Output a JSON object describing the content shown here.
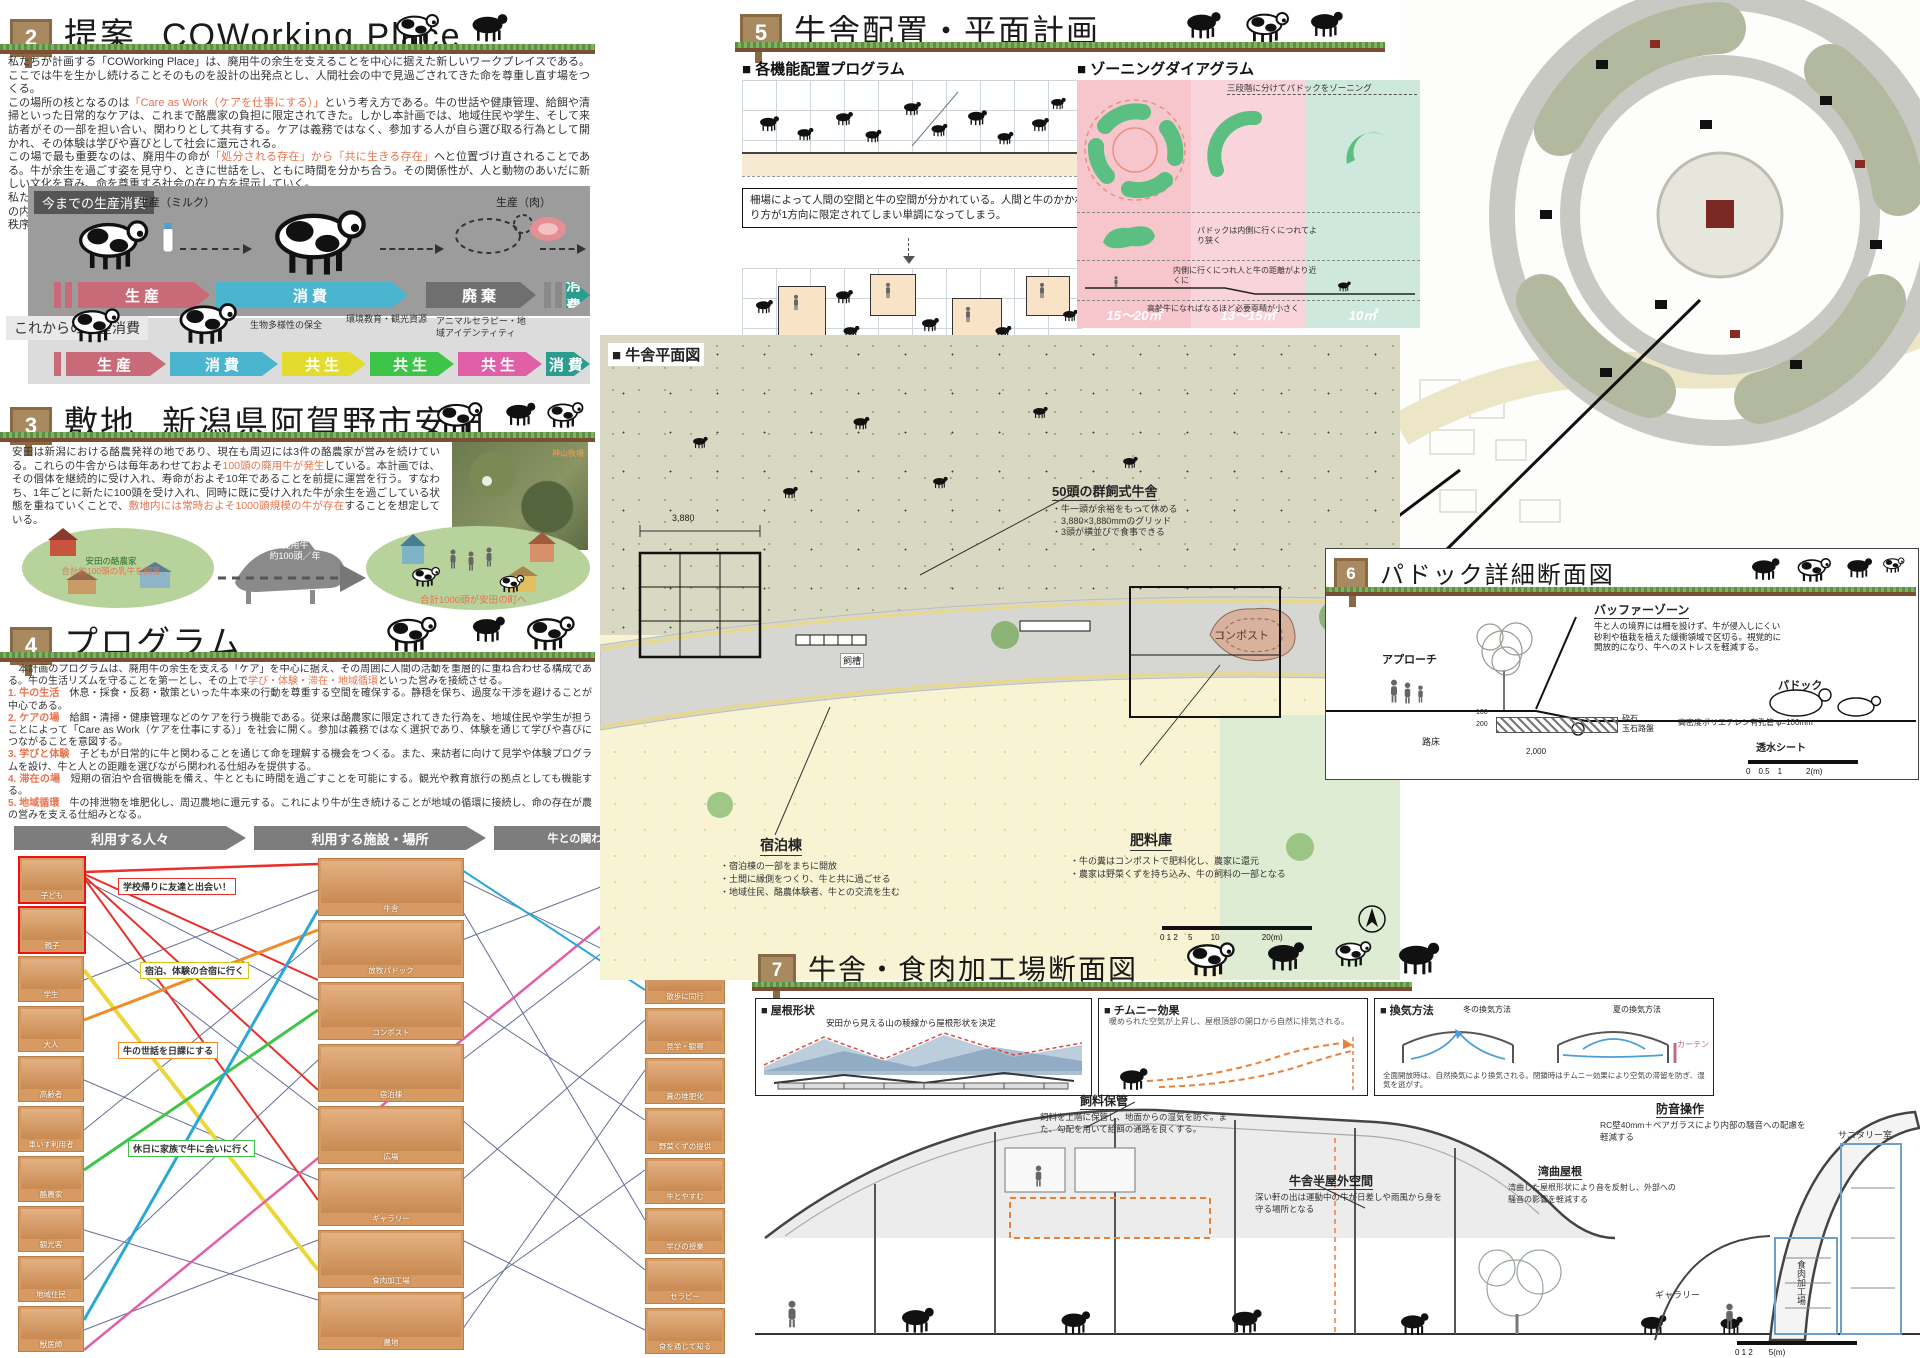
{
  "colors": {
    "accent_orange": "#e8734d",
    "flow_red": "#c96a78",
    "flow_blue": "#4ab5ce",
    "flow_gray": "#6f6f6f",
    "flow_teal": "#2a9d8f",
    "flow_yellow": "#e8e030",
    "flow_green": "#3fc44a",
    "flow_pink": "#e060a8",
    "zoning_pink": "#f7c6cd",
    "zoning_mint": "#cfe8dd",
    "tile_tan": "#d79a62"
  },
  "s2": {
    "num": "2",
    "title": "提案",
    "subtitle": "COWorking Place",
    "p1": "私たちが計画する「COWorking Place」は、廃用牛の余生を支えることを中心に据えた新しいワークプレイスである。ここでは牛を生かし続けることそのものを設計の出発点とし、人間社会の中で見過ごされてきた命を尊重し直す場をつくる。",
    "p2a": "この場所の核となるのは",
    "p2hl": "「Care as Work（ケアを仕事にする）」",
    "p2b": "という考え方である。牛の世話や健康管理、給餌や清掃といった日常的なケアは、これまで酪農家の負担に限定されてきた。しかし本計画では、地域住民や学生、そして来訪者がその一部を担い合い、関わりとして共有する。ケアは義務ではなく、参加する人が自ら選び取る行為として開かれ、その体験は学びや喜びとして社会に還元される。",
    "p3a": "この場で最も重要なのは、廃用牛の命が",
    "p3hl": "「処分される存在」から「共に生きる存在」",
    "p3b": "へと位置づけ直されることである。牛が余生を過ごす姿を見守り、ときに世話をし、ともに時間を分かち合う。その関係性が、人と動物のあいだに新しい文化を育み、命を尊重する社会の在り方を提示していく。",
    "p4": "私たちの提案は、牛を生かすという具体的な行為を通じて、人と牛の共生を日常に取り込み、生物多様性を人間社会の内部へと拡張する試みである。廃用牛を尊重し、その存在を地域社会に取り戻すことこそが、未来に向けた新しい秩序の提案だと考える。"
  },
  "flow": {
    "old_title": "今までの生産消費",
    "new_title": "これからの生産消費",
    "milk": "生産（ミルク）",
    "meat": "生産（肉）",
    "old_steps": [
      "生産",
      "消費",
      "廃棄",
      "消費"
    ],
    "new_steps": [
      "生産",
      "消費",
      "共生",
      "共生",
      "共生",
      "消費"
    ],
    "notes": [
      "生物多様性の保全",
      "環境教育・観光資源",
      "アニマルセラピー・地域アイデンティティ"
    ]
  },
  "s3": {
    "num": "3",
    "title": "敷地",
    "subtitle": "新潟県阿賀野市安田",
    "p_a": "安田は新潟における酪農発祥の地であり、現在も周辺には3件の酪農家が営みを続けている。これらの牛舎からは毎年あわせておよそ",
    "p_hl1": "100頭の廃用牛が発生",
    "p_b": "している。本計画では、その個体を継続的に受け入れ、寿命がおよそ10年であることを前提に運営を行う。すなわち、1年ごとに新たに100頭を受け入れ、同時に既に受け入れた牛が余生を過ごしている状態を重ねていくことで、",
    "p_hl2": "敷地内には常時およそ1000頭規模の牛が存在",
    "p_c": "することを想定している。",
    "d_left1": "安田の酪農家",
    "d_left2": "合計約100頭の乳牛を飼育",
    "d_cow1": "廃用牛",
    "d_cow2": "約100頭／年",
    "d_right": "合計1000頭が安田の町へ",
    "photo_label": "神山牧場"
  },
  "s4": {
    "num": "4",
    "title": "プログラム",
    "intro_a": "　本計画のプログラムは、廃用牛の余生を支える「ケア」を中心に据え、その周囲に人間の活動を重層的に重ね合わせる構成である。牛の生活リズムを守ることを第一とし、その上で",
    "intro_hl": "学び・体験・滞在・地域循環",
    "intro_b": "といった営みを接続させる。",
    "items": [
      {
        "h": "1. 牛の生活",
        "d": "　休息・採食・反芻・散策といった牛本来の行動を尊重する空間を確保する。静穏を保ち、過度な干渉を避けることが中心である。"
      },
      {
        "h": "2. ケアの場",
        "d": "　給餌・清掃・健康管理などのケアを行う機能である。従来は酪農家に限定されてきた行為を、地域住民や学生が担うことによって「Care as Work（ケアを仕事にする）」を社会に開く。参加は義務ではなく選択であり、体験を通じて学びや喜びにつながることを意図する。"
      },
      {
        "h": "3. 学びと体験",
        "d": "　子どもが日常的に牛と関わることを通じて命を理解する機会をつくる。また、来訪者に向けて見学や体験プログラムを設け、牛と人との距離を選びながら関われる仕組みを提供する。"
      },
      {
        "h": "4. 滞在の場",
        "d": "　短期の宿泊や合宿機能を備え、牛とともに時間を過ごすことを可能にする。観光や教育旅行の拠点としても機能する。"
      },
      {
        "h": "5. 地域循環",
        "d": "　牛の排泄物を堆肥化し、周辺農地に還元する。これにより牛が生き続けることが地域の循環に接続し、命の存在が農の営みを支える仕組みとなる。"
      }
    ],
    "outro_a": "以上のプログラムは、牛を単なる生産資源ではなく",
    "outro_hl": "「共に生きる存在」",
    "outro_b": "として位置づけ直し、人の営みと重ね合わせることで、新しい多様性の枠組みを提示するものである。"
  },
  "matrix": {
    "headers": [
      "利用する人々",
      "利用する施設・場所",
      "牛との関わり方・つながり方"
    ],
    "people": [
      "子ども",
      "親子",
      "学生",
      "大人",
      "高齢者",
      "車いす利用者",
      "酪農家",
      "観光客",
      "地域住民",
      "獣医師"
    ],
    "places": [
      "牛舎",
      "放牧パドック",
      "コンポスト",
      "宿泊棟",
      "広場",
      "ギャラリー",
      "食肉加工場",
      "農地"
    ],
    "relations": [
      "餌やり",
      "ブラッシング",
      "散歩に同行",
      "見学・観察",
      "糞の堆肥化",
      "野菜くずの提供",
      "牛とやすむ",
      "学びの授業",
      "セラピー",
      "食を通じて知る"
    ],
    "ribbons": [
      {
        "text": "学校帰りに友達と出会い！"
      },
      {
        "text": "宿泊、体験の合宿に行く"
      },
      {
        "text": "牛の世話を日課にする"
      },
      {
        "text": "休日に家族で牛に会いに行く"
      }
    ]
  },
  "s5": {
    "num": "5",
    "title": "牛舎配置・平面計画",
    "sub1": "各機能配置プログラム",
    "sub2": "ゾーニングダイアグラム",
    "box1": "柵場によって人間の空間と牛の空間が分かれている。人間と牛のかかわり方が1方向に限定されてしまい単調になってしまう。",
    "box2": "人間の活動空間を牛の空間にあふれださせる。人と牛が空間を共有し、様々な触れ合いが生まれる。",
    "zone_caption": "三段階に分けてパドックをゾーニング",
    "zone_notes": [
      "パドックは内側に行くにつれてより狭く",
      "内側に行くにつれ人と牛の距離がより近くに",
      "内側では人と牛が最も近くで過ごす",
      "高齢牛になればなるほど必要面積が小さく"
    ],
    "zone_values": [
      "15〜20㎡",
      "13〜15㎡",
      "10㎡"
    ]
  },
  "plan": {
    "title": "牛舎平面図",
    "barn_title": "50頭の群飼式牛舎",
    "barn_b1": "・牛一頭が余裕をもって休める",
    "barn_b2": "　3,880×3,880mmのグリッド",
    "barn_b3": "・3頭が横並びで食事できる",
    "dim": "3,880",
    "compost": "コンポスト",
    "trough": "飼槽",
    "lodging_title": "宿泊棟",
    "lodging_b1": "・宿泊棟の一部をまちに開放",
    "lodging_b2": "・土間に縁側をつくり、牛と共に過ごせる",
    "lodging_b3": "・地域住民、酪農体験者、牛との交流を生む",
    "fert_title": "肥料庫",
    "fert_b1": "・牛の糞はコンポストで肥料化し、農家に還元",
    "fert_b2": "・農家は野菜くずを持ち込み、牛の飼料の一部となる",
    "scale": "0 1 2　 5　　 10　　　　　 20(m)"
  },
  "s6": {
    "num": "6",
    "title": "パドック詳細断面図",
    "buffer_title": "バッファーゾーン",
    "buffer_text": "牛と人の境界には柵を設けず、牛が侵入しにくい砂利や植栽を植えた緩衝領域で区切る。視覚的に開放的になり、牛へのストレスを軽減する。",
    "approach": "アプローチ",
    "paddock": "パドック",
    "l_gravel": "砕石",
    "l_cobble": "玉石路盤",
    "l_pipe": "高密度ポリエチレン有孔管 φ=100mm",
    "l_roadbed": "路床",
    "l_sheet": "透水シート",
    "dim1": "100",
    "dim2": "200",
    "dim3": "2,000",
    "scale": "0　0.5　1　　　2(m)"
  },
  "s7": {
    "num": "7",
    "title": "牛舎・食肉加工場断面図",
    "b1_title": "屋根形状",
    "b1_cap": "安田から見える山の稜線から屋根形状を決定",
    "b2_title": "チムニー効果",
    "b2_cap": "暖められた空気が上昇し、屋根頂部の開口から自然に排気される。",
    "b3_title": "換気方法",
    "b3_w": "冬の換気方法",
    "b3_s": "夏の換気方法",
    "b3_curtain": "カーテン",
    "b3_cap": "全面開放時は、自然換気により換気される。閉鎖時はチムニー効果により空気の滞留を防ぎ、湿気を逃がす。",
    "feed_t": "飼料保管",
    "feed_d": "飼料を上階に保管し、地面からの湿気を防ぐ。また、勾配を用いて給餌の通路を良くする。",
    "semi_t": "牛舎半屋外空間",
    "semi_d": "深い軒の出は運動中の牛が日差しや雨風から身を守る場所となる",
    "sound_t": "防音操作",
    "sound_d": "RC壁40mm＋ペアガラスにより内部の騒音への配慮を軽減する",
    "roof_t": "湾曲屋根",
    "roof_d": "湾曲した屋根形状により音を反射し、外部への騒音の影響を軽減する",
    "gallery": "ギャラリー",
    "meat": "食肉加工場",
    "sanitary": "サニタリー室",
    "scale": "0 1 2　　5(m)"
  }
}
